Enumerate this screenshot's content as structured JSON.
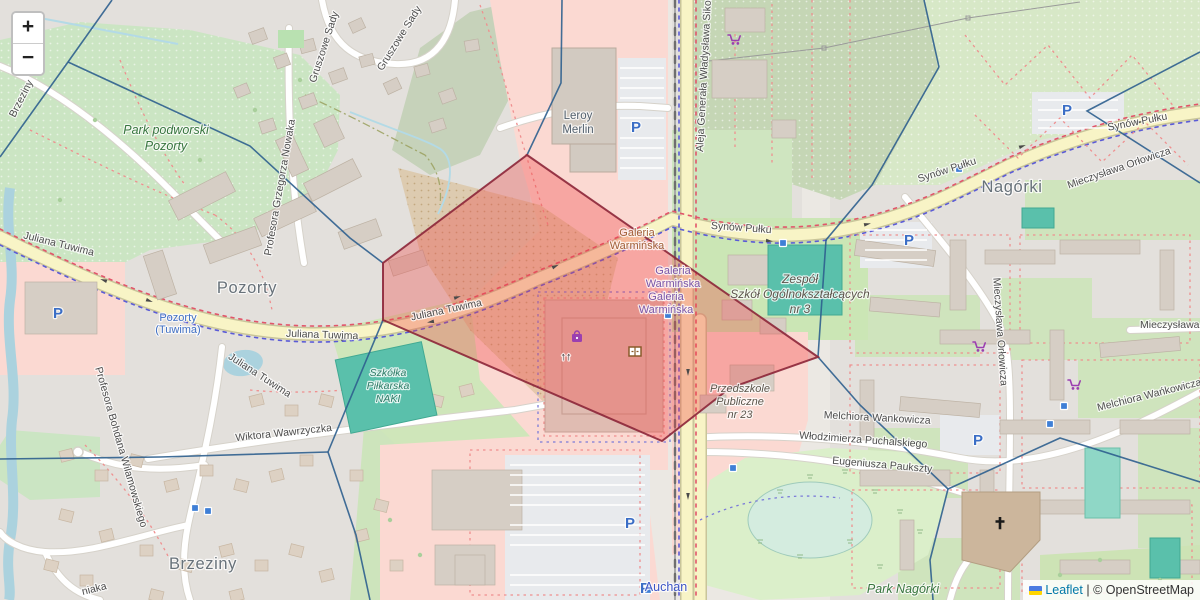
{
  "attribution": {
    "leaflet_label": "Leaflet",
    "separator": "|",
    "copyright_label": "© OpenStreetMap"
  },
  "zoom_control": {
    "zoom_in": "+",
    "zoom_out": "−"
  },
  "colors": {
    "highlight_fill": "#f04040",
    "highlight_stroke": "#8c2638",
    "voronoi_line": "#2e5f8e",
    "road_major": "#f8f4c6",
    "water": "#abd2de",
    "pitch_teal": "#5ac0ab",
    "retail_pink": "#fbd9d2",
    "park_green": "#cbe5c3",
    "parking_blue": "#3b6ec6",
    "poi_purple": "#9b3fb0"
  },
  "overlay": {
    "highlight_polygon": [
      [
        527,
        155
      ],
      [
        818,
        357
      ],
      [
        730,
        388
      ],
      [
        662,
        441
      ],
      [
        383,
        320
      ],
      [
        383,
        263
      ]
    ],
    "voronoi_lines": [
      [
        [
          112,
          0
        ],
        [
          68,
          62
        ],
        [
          0,
          157
        ]
      ],
      [
        [
          68,
          62
        ],
        [
          250,
          146
        ],
        [
          350,
          238
        ],
        [
          383,
          263
        ]
      ],
      [
        [
          383,
          320
        ],
        [
          328,
          452
        ]
      ],
      [
        [
          0,
          459
        ],
        [
          160,
          457
        ],
        [
          328,
          452
        ]
      ],
      [
        [
          328,
          452
        ],
        [
          356,
          535
        ],
        [
          370,
          600
        ]
      ],
      [
        [
          562,
          0
        ],
        [
          561,
          83
        ],
        [
          527,
          155
        ]
      ],
      [
        [
          924,
          0
        ],
        [
          939,
          67
        ]
      ],
      [
        [
          939,
          67
        ],
        [
          872,
          185
        ],
        [
          826,
          240
        ],
        [
          818,
          357
        ]
      ],
      [
        [
          1200,
          52
        ],
        [
          1087,
          111
        ],
        [
          1200,
          183
        ]
      ],
      [
        [
          818,
          357
        ],
        [
          860,
          405
        ],
        [
          948,
          489
        ]
      ],
      [
        [
          948,
          489
        ],
        [
          930,
          560
        ],
        [
          933,
          600
        ]
      ],
      [
        [
          948,
          489
        ],
        [
          1060,
          438
        ],
        [
          1200,
          482
        ]
      ]
    ]
  },
  "labels": {
    "places": [
      {
        "text": "Pozorty",
        "x": 247,
        "y": 293
      },
      {
        "text": "Brzeziny",
        "x": 203,
        "y": 569
      },
      {
        "text": "Nagórki",
        "x": 1012,
        "y": 192
      }
    ],
    "parks": [
      {
        "text": "Park podworski",
        "x": 166,
        "y": 134
      },
      {
        "text": "Pozorty",
        "x": 166,
        "y": 150
      },
      {
        "text": "Park Nagórki",
        "x": 903,
        "y": 593
      }
    ],
    "stations": [
      {
        "text": "Pozorty",
        "x": 178,
        "y": 321
      },
      {
        "text": "(Tuwima)",
        "x": 178,
        "y": 333
      }
    ],
    "streets": [
      {
        "text": "Juliana Tuwima",
        "x": 58,
        "y": 247,
        "rot": 14
      },
      {
        "text": "Juliana Tuwima",
        "x": 322,
        "y": 338,
        "rot": 2
      },
      {
        "text": "Juliana Tuwima",
        "x": 447,
        "y": 313,
        "rot": -12
      },
      {
        "text": "Juliana Tuwima",
        "x": 258,
        "y": 378,
        "rot": 33,
        "size": 9.5
      },
      {
        "text": "Synów Pułku",
        "x": 741,
        "y": 231,
        "rot": 4
      },
      {
        "text": "Synów Pułku",
        "x": 948,
        "y": 173,
        "rot": -18
      },
      {
        "text": "Synów Pułku",
        "x": 1138,
        "y": 125,
        "rot": -11
      },
      {
        "text": "Aleja Generała Władysława Sikorskiego",
        "x": 703,
        "y": 152,
        "rot": -87,
        "anchor": "start"
      },
      {
        "text": "Profesora Grzegorza Nowaka",
        "x": 283,
        "y": 188,
        "rot": -80
      },
      {
        "text": "Gruszowe Sady",
        "x": 327,
        "y": 48,
        "rot": -72
      },
      {
        "text": "Gruszowe Sady",
        "x": 402,
        "y": 40,
        "rot": -58
      },
      {
        "text": "Profesora Bohdana Wilamowskiego",
        "x": 118,
        "y": 448,
        "rot": 74
      },
      {
        "text": "Wiktora Wawrzyczka",
        "x": 284,
        "y": 436,
        "rot": -6
      },
      {
        "text": "Mieczysława Orłowicza",
        "x": 1120,
        "y": 171,
        "rot": -19
      },
      {
        "text": "Mieczysława Orłowicza",
        "x": 997,
        "y": 332,
        "rot": 86
      },
      {
        "text": "Mieczysława Orłowicza",
        "x": 1140,
        "y": 328,
        "rot": 0,
        "anchor": "start"
      },
      {
        "text": "Melchiora Wankowicza",
        "x": 877,
        "y": 421,
        "rot": 3
      },
      {
        "text": "Melchiora Wańkowicza",
        "x": 1150,
        "y": 398,
        "rot": -14
      },
      {
        "text": "Włodzimierza Puchalskiego",
        "x": 863,
        "y": 443,
        "rot": 4
      },
      {
        "text": "Eugeniusza Paukszty",
        "x": 882,
        "y": 468,
        "rot": 5
      },
      {
        "text": "Brzeziny",
        "x": 24,
        "y": 100,
        "rot": -63
      },
      {
        "text": "niaka",
        "x": 95,
        "y": 592,
        "rot": -14
      }
    ],
    "pois": [
      {
        "lines": [
          "Leroy",
          "Merlin"
        ],
        "x": 578,
        "y": 119,
        "lh": 14,
        "size": 11.5,
        "color": "#53616e",
        "italic": false
      },
      {
        "lines": [
          "Galeria",
          "Warmińska"
        ],
        "x": 637,
        "y": 236,
        "lh": 13,
        "size": 11,
        "color": "#a25f38",
        "italic": false
      },
      {
        "lines": [
          "Galeria",
          "Warmińska"
        ],
        "x": 673,
        "y": 274,
        "lh": 13,
        "size": 11,
        "color": "#7a55a8",
        "italic": false
      },
      {
        "lines": [
          "Galeria",
          "Warmińska"
        ],
        "x": 666,
        "y": 300,
        "lh": 13,
        "size": 11,
        "color": "#7a55a8",
        "italic": false
      },
      {
        "lines": [
          "Zespół",
          "Szkół Ogólnokształcących",
          "nr 3"
        ],
        "x": 800,
        "y": 283,
        "lh": 15,
        "size": 12,
        "color": "#5d564c",
        "italic": true
      },
      {
        "lines": [
          "Przedszkole",
          "Publiczne",
          "nr 23"
        ],
        "x": 740,
        "y": 392,
        "lh": 13,
        "size": 11,
        "color": "#5d564c",
        "italic": true
      },
      {
        "lines": [
          "Szkółka",
          "Piłkarska",
          "NAKI"
        ],
        "x": 388,
        "y": 376,
        "lh": 13,
        "size": 10.5,
        "color": "#2f7d68",
        "italic": true
      },
      {
        "lines": [
          "Auchan"
        ],
        "x": 666,
        "y": 591,
        "lh": 13,
        "size": 12.5,
        "color": "#3d55c5",
        "italic": false
      }
    ]
  },
  "markers": {
    "parking": [
      [
        58,
        313
      ],
      [
        636,
        127
      ],
      [
        909,
        240
      ],
      [
        1067,
        110
      ],
      [
        630,
        523
      ],
      [
        645,
        588
      ],
      [
        978,
        440
      ]
    ],
    "bus_stops": [
      [
        668,
        315
      ],
      [
        733,
        468
      ],
      [
        1064,
        406
      ],
      [
        1050,
        424
      ],
      [
        959,
        169
      ],
      [
        783,
        243
      ],
      [
        195,
        508
      ],
      [
        208,
        511
      ],
      [
        648,
        590
      ]
    ],
    "shopping_carts": [
      [
        735,
        40
      ],
      [
        980,
        347
      ],
      [
        1075,
        385
      ]
    ],
    "shopping_bag": [
      577,
      337
    ],
    "furniture_shop": [
      635,
      352
    ],
    "church_cross": [
      1000,
      523
    ],
    "escalator": [
      566,
      356
    ],
    "oneway_arrows": [
      [
        150,
        301,
        20
      ],
      [
        345,
        339,
        0
      ],
      [
        458,
        297,
        -17
      ],
      [
        556,
        266,
        -25
      ],
      [
        770,
        241,
        6
      ],
      [
        868,
        224,
        -12
      ],
      [
        1023,
        146,
        -20
      ],
      [
        1140,
        122,
        -8
      ],
      [
        688,
        373,
        90
      ],
      [
        688,
        497,
        90
      ],
      [
        103,
        280,
        200
      ],
      [
        430,
        322,
        170
      ]
    ]
  }
}
